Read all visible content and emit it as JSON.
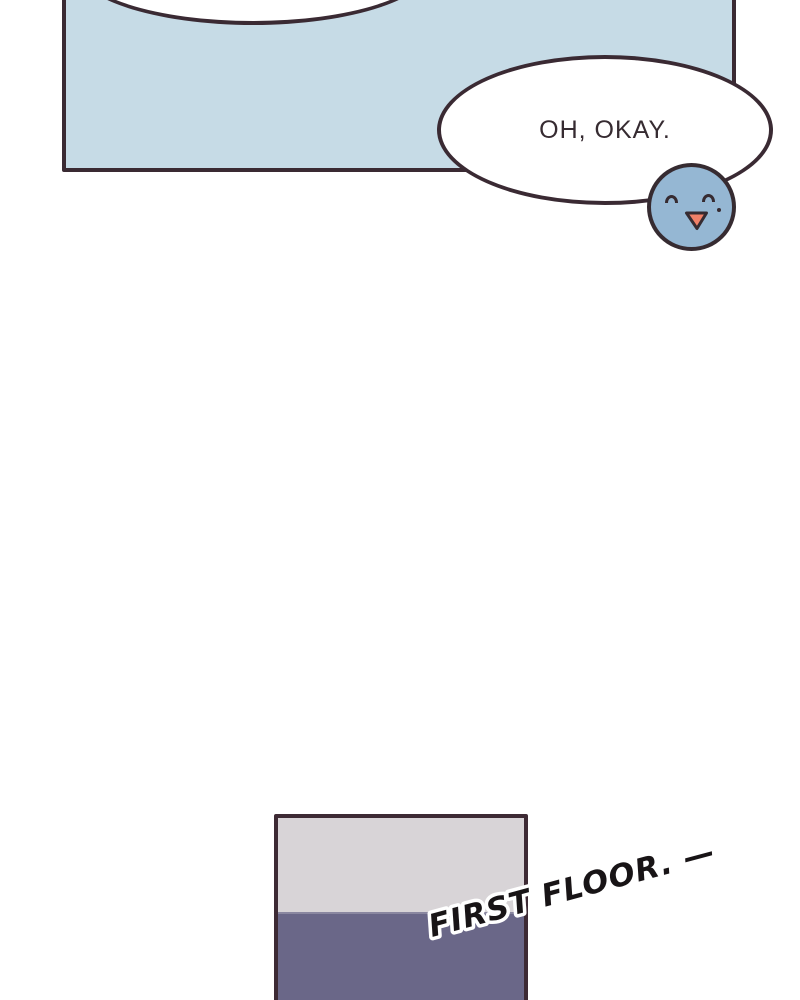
{
  "comic": {
    "dialogue": {
      "text": "OH, OKAY."
    },
    "caption": {
      "text": "FIRST FLOOR. —"
    }
  },
  "colors": {
    "page_background": "#ffffff",
    "outline": "#3a2a33",
    "panel_blue": "#c6dbe6",
    "bubble_white": "#ffffff",
    "dialogue_text": "#362b31",
    "face_blue": "#95b7d3",
    "face_outline": "#362b31",
    "tongue": "#f08068",
    "room_border": "#3d2a34",
    "room_upper_gray": "#d8d4d7",
    "room_lower_purple": "#6a6788",
    "caption_fill": "#181416",
    "caption_outline": "#ffffff"
  }
}
